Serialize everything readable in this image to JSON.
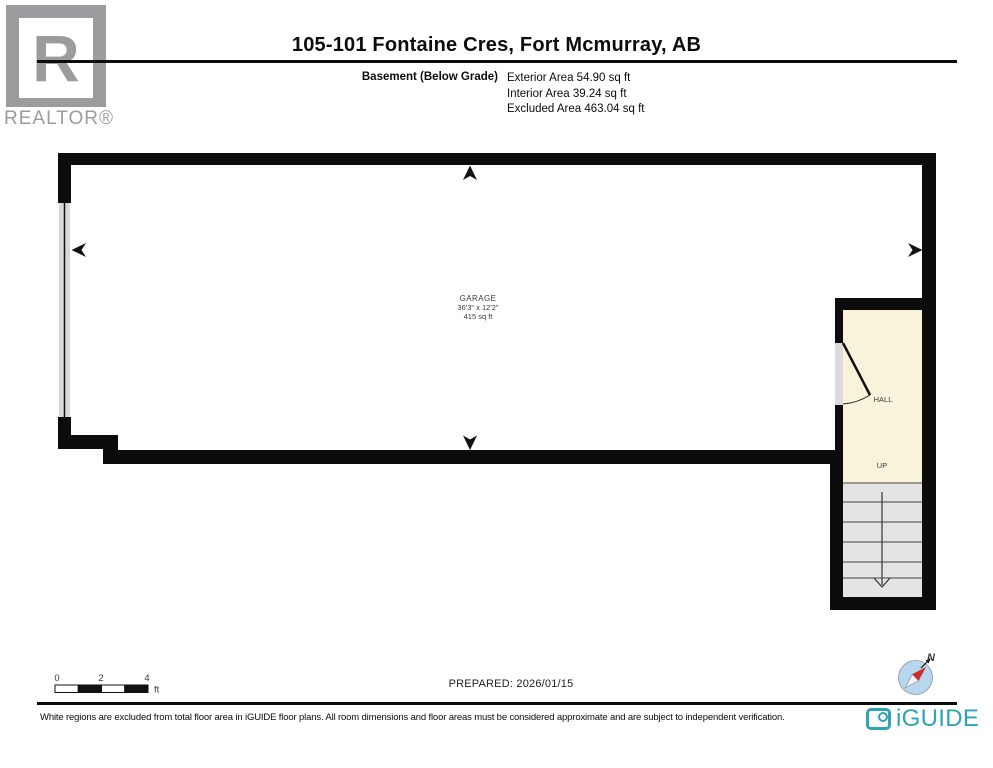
{
  "header": {
    "title": "105-101 Fontaine Cres, Fort Mcmurray, AB",
    "floor_label": "Basement (Below Grade)",
    "area_lines": [
      "Exterior Area 54.90 sq ft",
      "Interior Area 39.24 sq ft",
      "Excluded Area 463.04 sq ft"
    ]
  },
  "realtor": {
    "letter": "R",
    "wordmark": "REALTOR®"
  },
  "plan": {
    "garage": {
      "name": "GARAGE",
      "dimensions": "36'3\" x 12'2\"",
      "area": "415 sq ft"
    },
    "hall": {
      "name": "HALL"
    },
    "stairs": {
      "label": "UP"
    }
  },
  "scale_bar": {
    "ticks": [
      "0",
      "2",
      "4"
    ],
    "unit": "ft"
  },
  "prepared_label": "PREPARED: 2026/01/15",
  "compass": {
    "north_label": "N"
  },
  "footer": {
    "disclaimer": "White regions are excluded from total floor area in iGUIDE floor plans. All room dimensions and floor areas must be considered approximate and are subject to independent verification.",
    "brand": "iGUIDE"
  },
  "colors": {
    "wall": "#0c0c0c",
    "hall_floor": "#faf3dc",
    "stairs_floor": "#e4e4e4",
    "door_band": "#d9d9d9",
    "brand_teal": "#2fa3b6",
    "compass_blue": "#b7d7ee",
    "compass_red": "#d22b2b",
    "logo_gray": "#9c9c9e"
  }
}
